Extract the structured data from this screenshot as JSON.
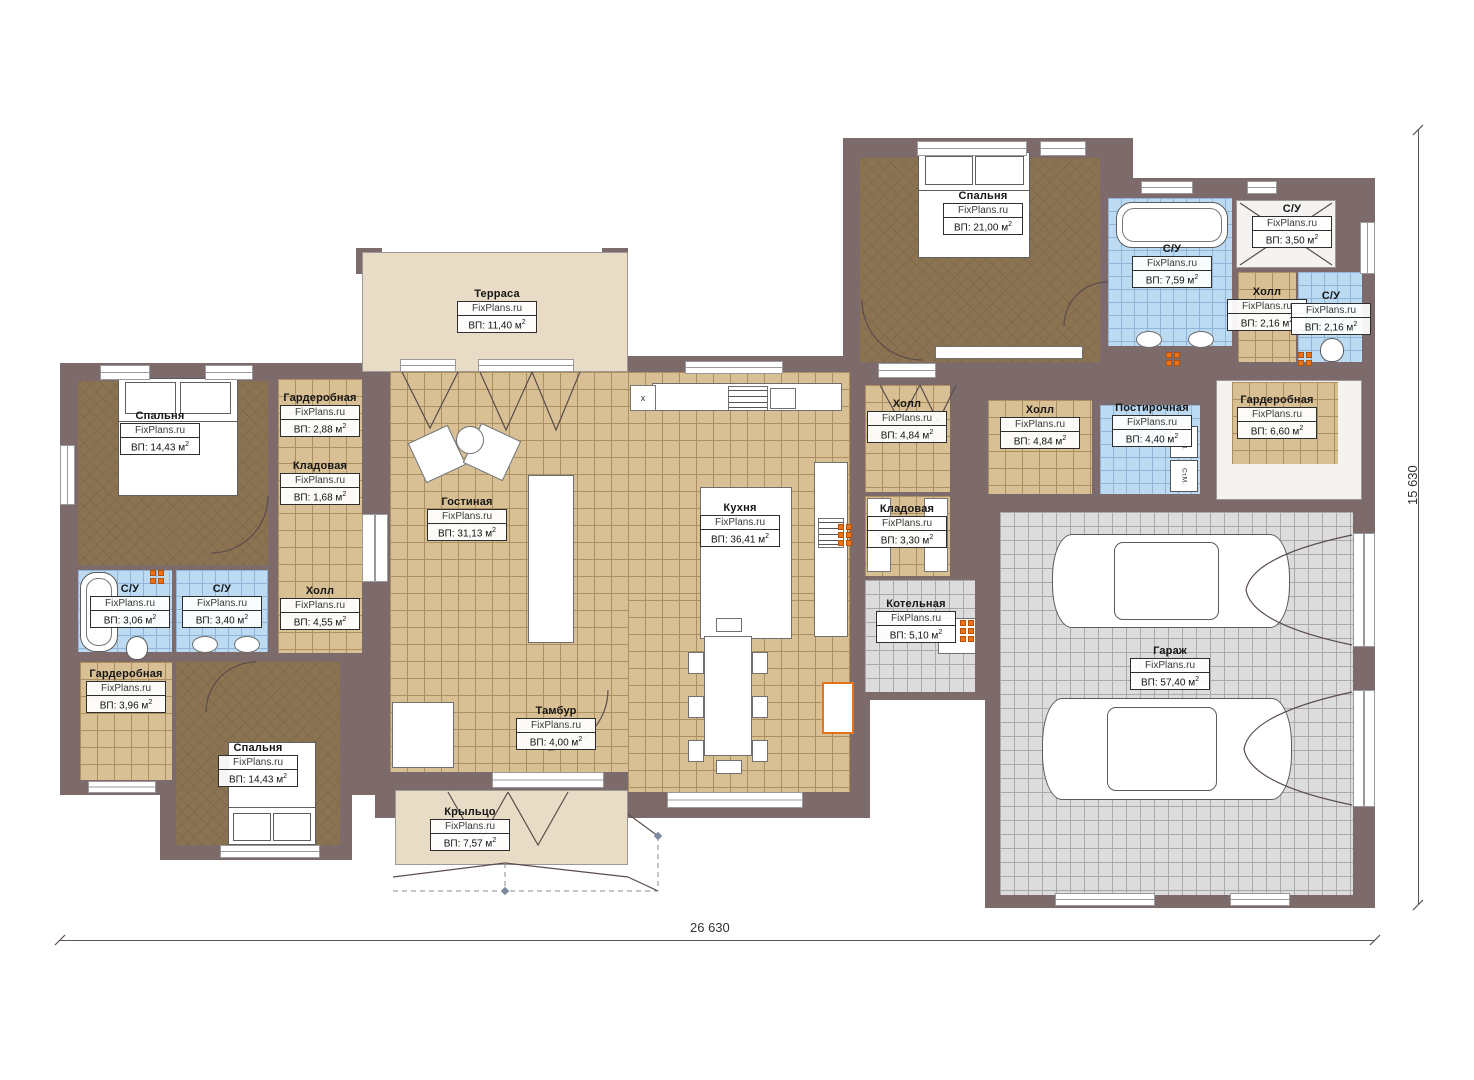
{
  "watermark": "FixPlans.ru",
  "dimensions": {
    "width_label": "26 630",
    "height_label": "15 630"
  },
  "misc": {
    "x_marker": "x",
    "washer_label": "Ст.М.",
    "cross": "✕"
  },
  "colors": {
    "wall": "#7d6b6b",
    "tan": "#d8c094",
    "blue": "#bcdaf2",
    "gray": "#dcdcdc",
    "brown": "#8b7352",
    "beige": "#e8dcc6",
    "heater": "#e8731e"
  },
  "rooms": [
    {
      "id": "terrace",
      "name": "Терраса",
      "area": "ВП: 11,40 м²",
      "floor": "beige",
      "rect": [
        362,
        252,
        266,
        120
      ],
      "label": [
        497,
        288
      ]
    },
    {
      "id": "bedroom-tl",
      "name": "Спальня",
      "area": "ВП: 14,43 м²",
      "floor": "brown",
      "rect": [
        78,
        381,
        190,
        184
      ],
      "label": [
        160,
        410
      ]
    },
    {
      "id": "wardrobe-tl",
      "name": "Гардеробная",
      "area": "ВП: 2,88 м²",
      "floor": "tan",
      "rect": [
        278,
        379,
        84,
        84
      ],
      "label": [
        320,
        392
      ]
    },
    {
      "id": "pantry-l",
      "name": "Кладовая",
      "area": "ВП: 1,68 м²",
      "floor": "tan",
      "rect": [
        278,
        463,
        84,
        50
      ],
      "label": [
        320,
        460
      ]
    },
    {
      "id": "hall-l",
      "name": "Холл",
      "area": "ВП: 4,55 м²",
      "floor": "tan",
      "rect": [
        278,
        513,
        84,
        140
      ],
      "label": [
        320,
        585
      ]
    },
    {
      "id": "su-l1",
      "name": "С/У",
      "area": "ВП: 3,06 м²",
      "floor": "blue",
      "rect": [
        78,
        570,
        94,
        82
      ],
      "label": [
        130,
        583
      ]
    },
    {
      "id": "su-l2",
      "name": "С/У",
      "area": "ВП: 3,40 м²",
      "floor": "blue",
      "rect": [
        176,
        570,
        92,
        82
      ],
      "label": [
        222,
        583
      ]
    },
    {
      "id": "wardrobe-bl",
      "name": "Гардеробная",
      "area": "ВП: 3,96 м²",
      "floor": "tan",
      "rect": [
        80,
        662,
        92,
        118
      ],
      "label": [
        126,
        668
      ]
    },
    {
      "id": "bedroom-bl",
      "name": "Спальня",
      "area": "ВП: 14,43 м²",
      "floor": "brown",
      "rect": [
        176,
        662,
        164,
        183
      ],
      "label": [
        258,
        742
      ]
    },
    {
      "id": "living",
      "name": "Гостиная",
      "area": "ВП: 31,13 м²",
      "floor": "tan",
      "rect": [
        390,
        372,
        460,
        400
      ],
      "label": [
        467,
        496
      ]
    },
    {
      "id": "dining-ext",
      "name": "",
      "area": "",
      "floor": "tan",
      "rect": [
        628,
        600,
        222,
        192
      ],
      "label": null
    },
    {
      "id": "kitchen",
      "name": "Кухня",
      "area": "ВП: 36,41 м²",
      "floor": null,
      "rect": null,
      "label": [
        740,
        502
      ]
    },
    {
      "id": "tambur",
      "name": "Тамбур",
      "area": "ВП: 4,00 м²",
      "floor": null,
      "rect": null,
      "label": [
        556,
        705
      ]
    },
    {
      "id": "porch",
      "name": "Крыльцо",
      "area": "ВП: 7,57 м²",
      "floor": "beige",
      "rect": [
        395,
        790,
        233,
        75
      ],
      "label": [
        470,
        806
      ]
    },
    {
      "id": "hall-c",
      "name": "Холл",
      "area": "ВП: 4,84 м²",
      "floor": "tan",
      "rect": [
        865,
        385,
        85,
        107
      ],
      "label": [
        907,
        398
      ]
    },
    {
      "id": "pantry-c",
      "name": "Кладовая",
      "area": "ВП: 3,30 м²",
      "floor": "tan",
      "rect": [
        865,
        496,
        85,
        80
      ],
      "label": [
        907,
        503
      ]
    },
    {
      "id": "boiler",
      "name": "Котельная",
      "area": "ВП: 5,10 м²",
      "floor": "gray",
      "rect": [
        865,
        580,
        110,
        112
      ],
      "label": [
        916,
        598
      ]
    },
    {
      "id": "bedroom-tr",
      "name": "Спальня",
      "area": "ВП: 21,00 м²",
      "floor": "brown",
      "rect": [
        860,
        158,
        240,
        204
      ],
      "label": [
        983,
        190
      ]
    },
    {
      "id": "su-tr1",
      "name": "С/У",
      "area": "ВП: 7,59 м²",
      "floor": "blue",
      "rect": [
        1108,
        198,
        124,
        148
      ],
      "label": [
        1172,
        243
      ]
    },
    {
      "id": "su-tr2",
      "name": "С/У",
      "area": "ВП: 3,50 м²",
      "floor": "white",
      "rect": [
        1236,
        200,
        100,
        68
      ],
      "label": [
        1292,
        203
      ]
    },
    {
      "id": "hall-tr",
      "name": "Холл",
      "area": "ВП: 2,16 м²",
      "floor": "tan",
      "rect": [
        1238,
        272,
        58,
        90
      ],
      "label": [
        1267,
        286
      ]
    },
    {
      "id": "su-tr3",
      "name": "С/У",
      "area": "ВП: 2,16 м²",
      "floor": "blue",
      "rect": [
        1298,
        272,
        64,
        90
      ],
      "label": [
        1331,
        290
      ]
    },
    {
      "id": "hall-r",
      "name": "Холл",
      "area": "ВП: 4,84 м²",
      "floor": "tan",
      "rect": [
        988,
        400,
        104,
        94
      ],
      "label": [
        1040,
        404
      ]
    },
    {
      "id": "laundry",
      "name": "Постирочная",
      "area": "ВП: 4,40 м²",
      "floor": "blue",
      "rect": [
        1100,
        405,
        100,
        89
      ],
      "label": [
        1152,
        402
      ]
    },
    {
      "id": "wardrobe-r",
      "name": "Гардеробная",
      "area": "ВП: 6,60 м²",
      "floor": "tan",
      "rect": [
        1232,
        382,
        106,
        82
      ],
      "label": [
        1277,
        394
      ],
      "backing": [
        1216,
        380,
        146,
        120
      ]
    },
    {
      "id": "garage",
      "name": "Гараж",
      "area": "ВП: 57,40 м²",
      "floor": "gray",
      "rect": [
        1000,
        512,
        353,
        383
      ],
      "label": [
        1170,
        645
      ]
    }
  ],
  "walls": [
    [
      60,
      363,
      318,
      432
    ],
    [
      160,
      648,
      192,
      212
    ],
    [
      375,
      356,
      495,
      462
    ],
    [
      843,
      138,
      290,
      242
    ],
    [
      1125,
      178,
      250,
      202
    ],
    [
      843,
      356,
      147,
      344
    ],
    [
      985,
      356,
      390,
      156
    ],
    [
      985,
      490,
      390,
      418
    ],
    [
      448,
      690,
      34,
      112
    ],
    [
      606,
      688,
      34,
      114
    ],
    [
      356,
      248,
      26,
      26
    ],
    [
      602,
      248,
      26,
      26
    ]
  ],
  "windows": [
    {
      "r": [
        100,
        365,
        50,
        15
      ],
      "o": "h"
    },
    {
      "r": [
        205,
        365,
        48,
        15
      ],
      "o": "h"
    },
    {
      "r": [
        400,
        359,
        56,
        13
      ],
      "o": "h"
    },
    {
      "r": [
        478,
        359,
        96,
        13
      ],
      "o": "h"
    },
    {
      "r": [
        685,
        361,
        98,
        13
      ],
      "o": "h"
    },
    {
      "r": [
        917,
        141,
        110,
        15
      ],
      "o": "h"
    },
    {
      "r": [
        1040,
        141,
        46,
        15
      ],
      "o": "h"
    },
    {
      "r": [
        1141,
        181,
        52,
        13
      ],
      "o": "h"
    },
    {
      "r": [
        1247,
        181,
        30,
        13
      ],
      "o": "h"
    },
    {
      "r": [
        220,
        845,
        100,
        13
      ],
      "o": "h"
    },
    {
      "r": [
        88,
        781,
        68,
        12
      ],
      "o": "h"
    },
    {
      "r": [
        667,
        792,
        136,
        16
      ],
      "o": "h"
    },
    {
      "r": [
        1055,
        893,
        100,
        13
      ],
      "o": "h"
    },
    {
      "r": [
        1230,
        893,
        60,
        13
      ],
      "o": "h"
    },
    {
      "r": [
        362,
        514,
        26,
        68
      ],
      "o": "v"
    },
    {
      "r": [
        878,
        363,
        58,
        15
      ],
      "o": "h"
    },
    {
      "r": [
        492,
        772,
        112,
        16
      ],
      "o": "h"
    },
    {
      "r": [
        1353,
        533,
        22,
        114
      ],
      "o": "v"
    },
    {
      "r": [
        1353,
        690,
        22,
        117
      ],
      "o": "v"
    },
    {
      "r": [
        60,
        445,
        15,
        60
      ],
      "o": "v"
    },
    {
      "r": [
        1360,
        222,
        15,
        52
      ],
      "o": "v"
    }
  ],
  "furniture": [
    {
      "t": "bed",
      "r": [
        118,
        378,
        120,
        118
      ],
      "pil": "top"
    },
    {
      "t": "bed",
      "r": [
        918,
        152,
        112,
        106
      ],
      "pil": "top"
    },
    {
      "t": "bed",
      "r": [
        228,
        742,
        88,
        103
      ],
      "pil": "bottom"
    },
    {
      "t": "white",
      "r": [
        528,
        475,
        46,
        168
      ]
    },
    {
      "t": "white",
      "r": [
        415,
        432,
        44,
        44
      ],
      "rot": -25
    },
    {
      "t": "white",
      "r": [
        470,
        430,
        44,
        44
      ],
      "rot": 25
    },
    {
      "t": "ellipse",
      "r": [
        456,
        426,
        28,
        28
      ]
    },
    {
      "t": "white",
      "r": [
        652,
        383,
        190,
        28
      ]
    },
    {
      "t": "stove",
      "r": [
        728,
        386,
        40,
        25
      ]
    },
    {
      "t": "white",
      "r": [
        770,
        388,
        26,
        21
      ]
    },
    {
      "t": "white",
      "r": [
        700,
        487,
        92,
        152
      ]
    },
    {
      "t": "white",
      "r": [
        814,
        462,
        34,
        175
      ]
    },
    {
      "t": "stove",
      "r": [
        818,
        518,
        26,
        30
      ]
    },
    {
      "t": "white",
      "r": [
        704,
        636,
        48,
        120
      ]
    },
    {
      "t": "white",
      "r": [
        688,
        652,
        16,
        22
      ]
    },
    {
      "t": "white",
      "r": [
        688,
        696,
        16,
        22
      ]
    },
    {
      "t": "white",
      "r": [
        688,
        740,
        16,
        22
      ]
    },
    {
      "t": "white",
      "r": [
        752,
        652,
        16,
        22
      ]
    },
    {
      "t": "white",
      "r": [
        752,
        696,
        16,
        22
      ]
    },
    {
      "t": "white",
      "r": [
        752,
        740,
        16,
        22
      ]
    },
    {
      "t": "white",
      "r": [
        716,
        618,
        26,
        14
      ]
    },
    {
      "t": "white",
      "r": [
        716,
        760,
        26,
        14
      ]
    },
    {
      "t": "tub",
      "r": [
        80,
        572,
        38,
        80
      ]
    },
    {
      "t": "tub",
      "r": [
        1116,
        202,
        112,
        46
      ]
    },
    {
      "t": "ellipse",
      "r": [
        192,
        636,
        26,
        17
      ]
    },
    {
      "t": "ellipse",
      "r": [
        234,
        636,
        26,
        17
      ]
    },
    {
      "t": "ellipse",
      "r": [
        1136,
        331,
        26,
        17
      ]
    },
    {
      "t": "ellipse",
      "r": [
        1188,
        331,
        26,
        17
      ]
    },
    {
      "t": "toilet",
      "r": [
        126,
        636,
        22,
        24
      ]
    },
    {
      "t": "toilet",
      "r": [
        1320,
        338,
        24,
        24
      ]
    },
    {
      "t": "white",
      "r": [
        938,
        618,
        38,
        36
      ]
    },
    {
      "t": "white",
      "r": [
        935,
        346,
        148,
        13
      ]
    },
    {
      "t": "car",
      "r": [
        1052,
        534,
        238,
        94
      ]
    },
    {
      "t": "car",
      "r": [
        1042,
        698,
        250,
        102
      ]
    },
    {
      "t": "orangebox",
      "r": [
        822,
        682,
        32,
        52
      ]
    },
    {
      "t": "white",
      "r": [
        392,
        702,
        62,
        66
      ]
    },
    {
      "t": "crossbox",
      "r": [
        867,
        498,
        24,
        74
      ]
    },
    {
      "t": "crossbox",
      "r": [
        924,
        498,
        24,
        74
      ]
    }
  ],
  "washers": [
    {
      "r": [
        1170,
        426,
        28,
        32
      ]
    },
    {
      "r": [
        1170,
        460,
        28,
        32
      ]
    }
  ],
  "x_marker_rect": [
    630,
    385,
    26,
    26
  ],
  "heaters": [
    {
      "x": 150,
      "y": 570,
      "rows": 2,
      "cols": 2
    },
    {
      "x": 838,
      "y": 524,
      "rows": 3,
      "cols": 2
    },
    {
      "x": 960,
      "y": 620,
      "rows": 3,
      "cols": 2
    },
    {
      "x": 1166,
      "y": 352,
      "rows": 2,
      "cols": 2
    },
    {
      "x": 1298,
      "y": 352,
      "rows": 2,
      "cols": 2
    }
  ],
  "decor": {
    "solid": [
      "M402,372 L430,428 L458,372 M480,372 L506,430 L532,372 M532,372 L556,430 L580,372",
      "M448,792 L478,845 L508,792 M508,792 L538,845 L568,792",
      "M880,385 L900,422 L920,385 M920,385 L938,422 L956,385",
      "M1240,203 L1332,265 M1332,203 L1240,265",
      "M1352,535 Q1252,556 1246,590 M1352,645 Q1252,624 1246,590 M1352,692 Q1250,714 1244,749 M1352,805 Q1250,784 1244,749",
      "M268,496 A57,57 0 0 1 211,553 M256,662 A50,50 0 0 0 206,712 M862,300 A60,60 0 0 0 922,360 M1108,282 A44,44 0 0 0 1064,326 M608,690 A60,60 0 0 1 548,750",
      "M393,877 L505,863 L628,877 M628,814 L658,836 M628,877 L658,891",
      "M55,945 L65,935 M1370,945 L1380,935 M1413,135 L1423,125 M1413,910 L1423,900"
    ],
    "dashed": [
      "M393,891 L658,891 M505,863 L505,891 M658,836 L658,891"
    ],
    "markers": [
      [
        505,
        891
      ],
      [
        658,
        836
      ]
    ]
  },
  "dimension_lines": {
    "bottom": [
      60,
      940,
      1315
    ],
    "right": [
      1418,
      130,
      775
    ]
  }
}
